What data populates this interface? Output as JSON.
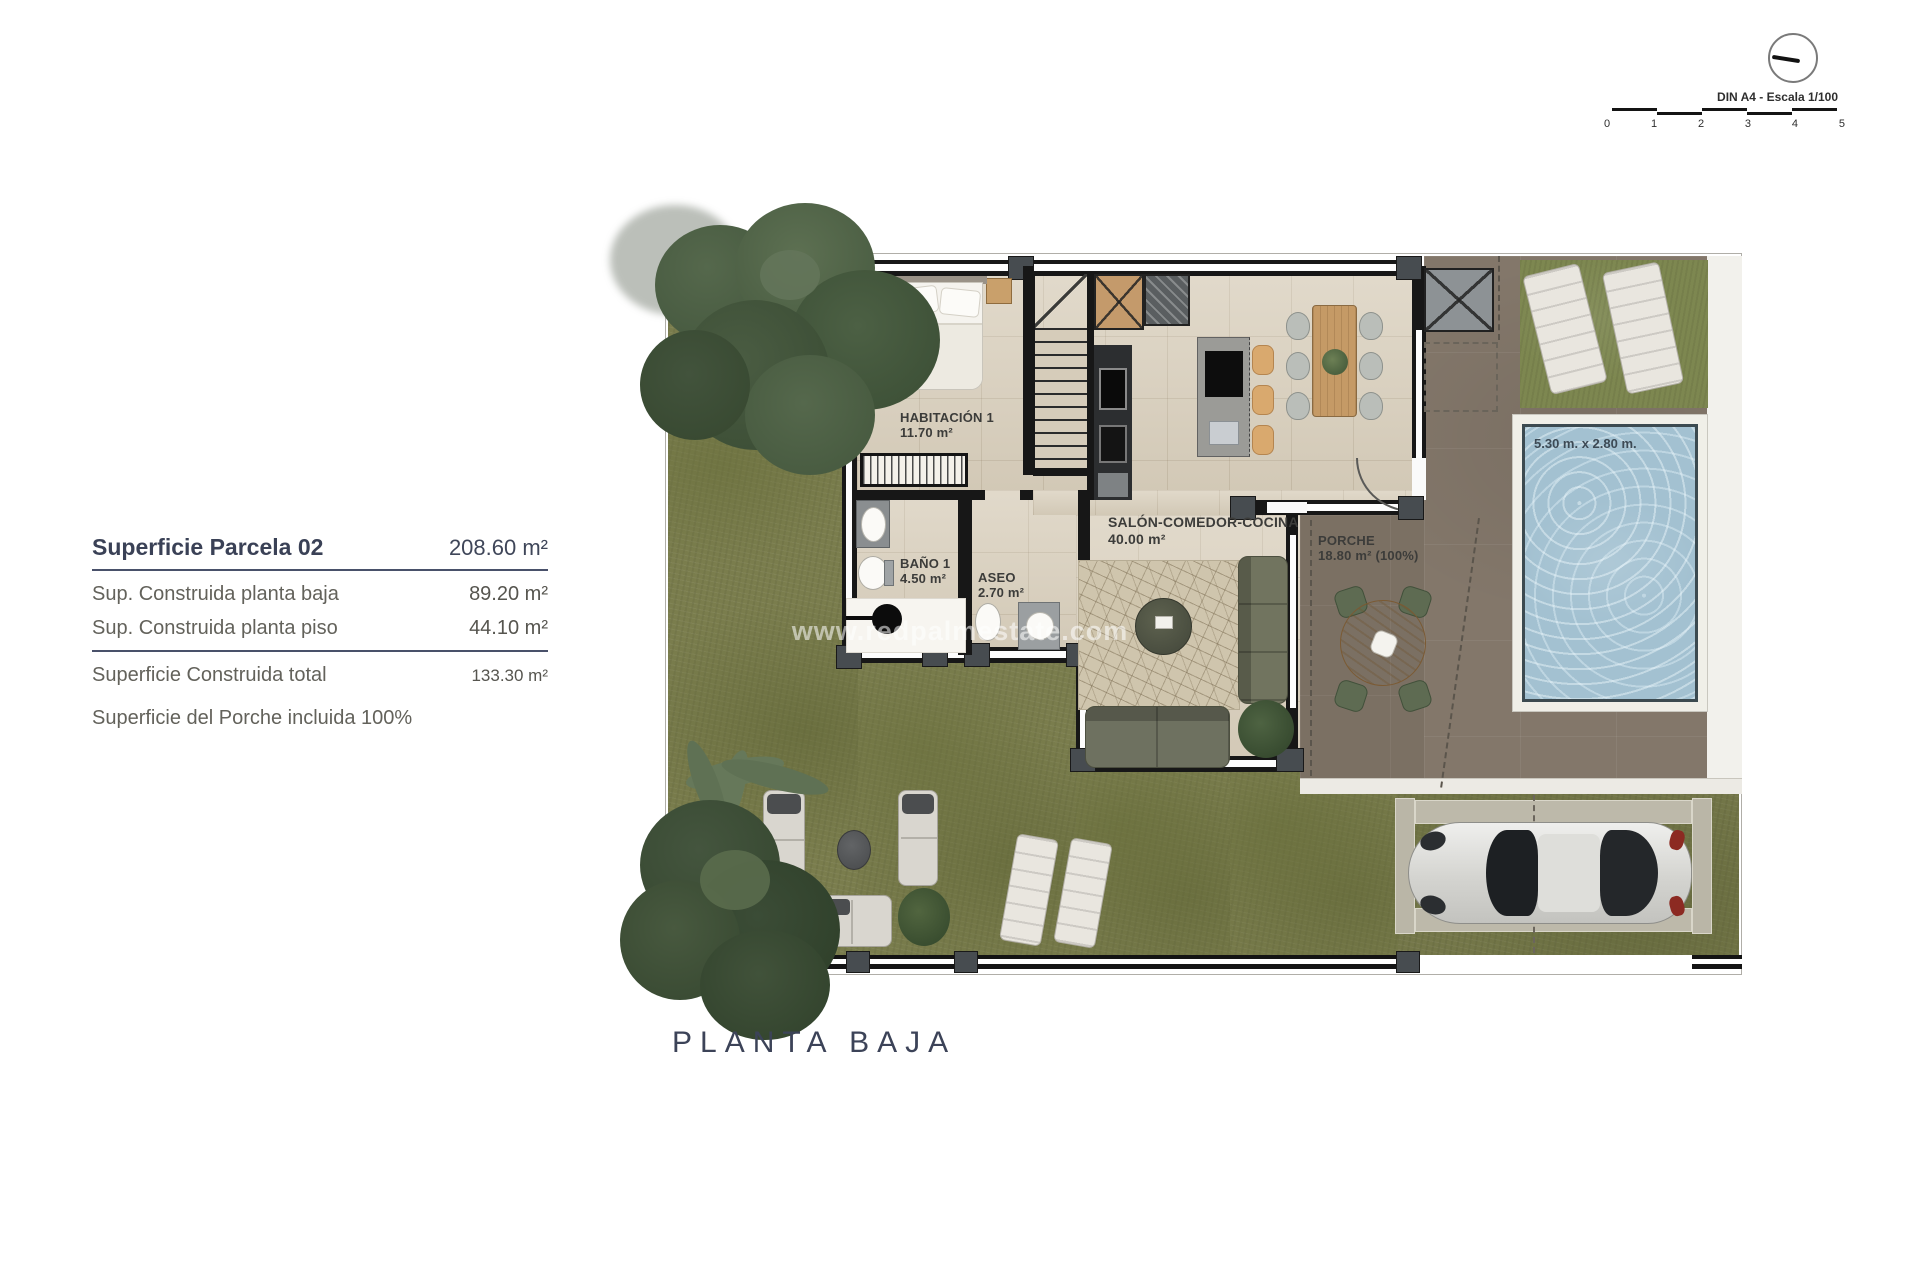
{
  "scale_widget": {
    "label": "DIN A4 - Escala 1/100",
    "ticks": [
      "0",
      "1",
      "2",
      "3",
      "4",
      "5"
    ]
  },
  "info_panel": {
    "title": {
      "label": "Superficie Parcela 02",
      "value": "208.60 m²"
    },
    "rows": [
      {
        "label": "Sup. Construida planta baja",
        "value": "89.20 m²"
      },
      {
        "label": "Sup. Construida planta piso",
        "value": "44.10 m²"
      }
    ],
    "total": {
      "label": "Superficie Construida total",
      "value": "133.30 m²"
    },
    "note": "Superficie del Porche incluida 100%"
  },
  "plan": {
    "title": "PLANTA BAJA",
    "watermark": "www.redpalmestate.com",
    "rooms": {
      "habitacion": {
        "name": "HABITACIÓN 1",
        "area": "11.70 m²"
      },
      "bano": {
        "name": "BAÑO 1",
        "area": "4.50 m²"
      },
      "aseo": {
        "name": "ASEO",
        "area": "2.70 m²"
      },
      "salon": {
        "name": "SALÓN-COMEDOR-COCINA",
        "area": "40.00 m²"
      },
      "porche": {
        "name": "PORCHE",
        "area": "18.80 m² (100%)"
      }
    },
    "pool": {
      "dimensions": "5.30 m. x 2.80 m."
    }
  },
  "colors": {
    "text_navy": "#3c4358",
    "grass": "#7a7d4d",
    "floor": "#d9cfbc",
    "terrace": "#83776a",
    "pool_water": "#a3c1d1",
    "wall": "#171717"
  }
}
